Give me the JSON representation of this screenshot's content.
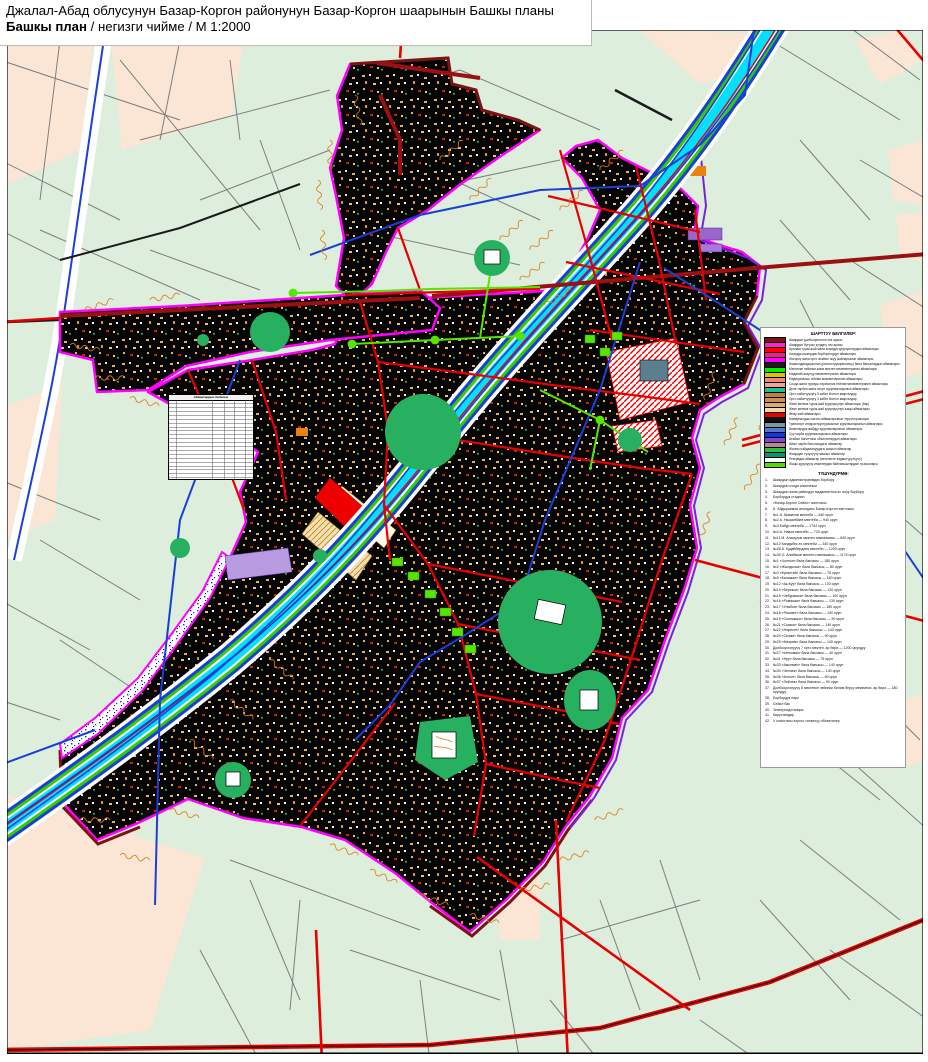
{
  "header": {
    "title": "Джалал-Абад облусунун Базар-Коргон районунун Базар-Коргон шаарынын Башкы планы",
    "plan_bold": "Башкы план",
    "plan_rest": " / негизги чийме / М 1:2000"
  },
  "legend": {
    "title": "ШАРТТУУ БЕЛГИЛЕР:",
    "items": [
      {
        "color": "#7a1414",
        "label": "Шаардын долбоорлонгон чек арасы"
      },
      {
        "color": "#ff22cc",
        "label": "Шаардын бүгүнкү күндөгү чек арасы"
      },
      {
        "color": "#ff0000",
        "label": "Аралаш турак-жай жана коомдук курулуштардын аймактары"
      },
      {
        "color": "#ff1493",
        "label": "Коомдук-ишкердик борборлордун аймактары"
      },
      {
        "color": "#ff00ff",
        "label": "Жогорку жана орто атайын окуу жайларынын аймактары"
      },
      {
        "color": "#1c1c1c",
        "label": "Жашылдандырылган (реконструкцияланчу) бала бакчалардын аймактары"
      },
      {
        "color": "#00ee00",
        "label": "Мектепке чейинки жана мектеп мекемелеринин аймактары"
      },
      {
        "color": "#d8c400",
        "label": "Маданий-агартуу мекемелеринин аймактары"
      },
      {
        "color": "#ef8877",
        "label": "Медициналык тейлөө мекемелеринин аймактары"
      },
      {
        "color": "#f4a38e",
        "label": "Соода жана турмуш-тиричилик тейлөө мекемелеринин аймактары"
      },
      {
        "color": "#17c68e",
        "label": "Дене тарбия жана спорт курулмаларынын аймактары"
      },
      {
        "color": "#bf8040",
        "label": "Орто кабаттуулугу 5 кабат болгон кварталдар"
      },
      {
        "color": "#cd9154",
        "label": "Орто кабаттуулугу 3 кабат болгон кварталдар"
      },
      {
        "color": "#dcab75",
        "label": "Жеке менчик турак-жай курулушунун аймактары (бар)"
      },
      {
        "color": "#f0d6ac",
        "label": "Жеке менчик турак-жай курулушунун жаңы аймактары"
      },
      {
        "color": "#ee0000",
        "label": "Өнөр жай аймактары"
      },
      {
        "color": "#101010",
        "label": "Коммуналдык-сактоо аймактарынын территориялары"
      },
      {
        "color": "#7e96a4",
        "label": "Транспорт инфраструктурасынын курулмаларынын аймактары"
      },
      {
        "color": "#5577cc",
        "label": "Инженердик жабдуу курулмаларынын аймактары"
      },
      {
        "color": "#1133ee",
        "label": "Суу чарба курулмаларынын аймактары"
      },
      {
        "color": "#8844cc",
        "label": "Атайын багыттагы объектилердин аймактары"
      },
      {
        "color": "#b38b8b",
        "label": "Айыл чарба багытындагы аймактар"
      },
      {
        "color": "#33bb44",
        "label": "Жалпы пайдалануудагы жашыл аймактар"
      },
      {
        "color": "#00996b",
        "label": "Жаңыдан түзүлүүчү жашыл аймактар"
      },
      {
        "color": "#ffffff",
        "label": "Резервдик аймактар (келечекте өздөштүрүлүүчү)"
      },
      {
        "color": "#55dd00",
        "label": "Жаңы курулуучу инженердик байланыштардын трассалары"
      }
    ]
  },
  "explanation": {
    "title": "ТҮШҮНДҮРМӨ:",
    "items": [
      "Шаардын административдик борбору",
      "Шаардын соода комплекси",
      "Шаардын жана райондун маданияттык-эс алуу борбору",
      "Борбордук стадион",
      "«Базар-Коргон Сейил» аянтчасы",
      "Б. Абдыраимов атындагы Базар-Коргон аянтчасы",
      "№1 А. Шаматов мектеби — 640 орун",
      "№2 А. Нышанбаев мектеби — 940 орун",
      "№3 Бабур мектеби — 1744 орун",
      "№4 А. Навои мектеби — 720 орун",
      "№11 М. Алыкулов мектеп-гимназиясы — 840 орун",
      "№12 Кандыбек ат. мектеби — 240 орун",
      "№28 А. Кудайбердиев мектеби — 1200 орун",
      "№30 О. Алибеков мектеп-гимназиясы — 1176 орун",
      "№1 «Чолпон» бала бакчасы — 180 орун",
      "№2 «Жылдызча» бала бакчасы — 80 орун",
      "№3 «Күнөстөй» бала бакчасы — 75 орун",
      "№5 «Балажан» бала бакчасы — 160 орун",
      "№12 «Ак-Куу» бала бакчасы — 130 орун",
      "№14 «Березка» бала бакчасы — 120 орун",
      "№15 «Чебурашка» бала бакчасы — 100 орун",
      "№16 «Ромашка» бала бакчасы — 130 орун",
      "№17 «Улыбка» бала бакчасы — 180 орун",
      "№18 «Рассвет» бала бакчасы — 140 орун",
      "№19 «Солнышко» бала бакчасы — 90 орун",
      "№21 «Сказка» бала бакчасы — 140 орун",
      "№22 «Наристе» бала бакчасы — 140 орун",
      "№24 «Сезим» бала бакчасы — 90 орун",
      "№25 «Мээрим» бала бакчасы — 140 орун",
      "Долбоорлонуучу 7 орто мектеп, ар бири — 1200 орундуу",
      "№27 «Ынтымак» бала бакчасы — 40 орун",
      "№31 «Нур» бала бакчасы — 75 орун",
      "№33 «Акылман» бала бакчасы — 140 орун",
      "№34 «Челпек» бала бакчасы — 140 орун",
      "№36 «Алтын» бала бакчасы — 60 орун",
      "№37 «Лейлек» бала бакчасы — 90 орун",
      "Долбоорлонуучу 8 мектепке чейинки билим берүү мекемеси, ар бири — 180 орундуу",
      "Борбордук парк",
      "Сейил бак",
      "Электрподстанция",
      "Көрүстөндөр",
      "V класстагы коргоо тилкелүү объектилер"
    ]
  },
  "land_table": {
    "title": "Аймактардын балансы"
  }
}
